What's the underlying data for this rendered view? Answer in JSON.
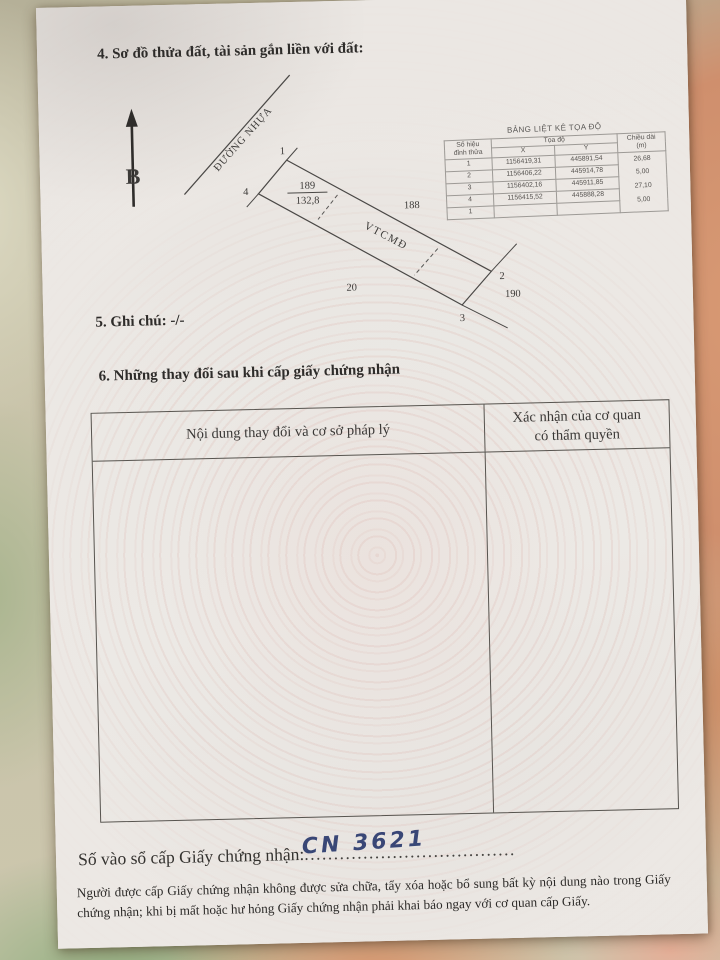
{
  "colors": {
    "ink": "#2e2c2a",
    "handwriting_ink": "#2b3a6e",
    "paper": "#eae6e2"
  },
  "document": {
    "section4_title": "4. Sơ đồ thửa đất, tài sản gắn liền với đất:",
    "section5_text": "5. Ghi chú: -/-",
    "section6_title": "6. Những thay đổi sau khi cấp giấy chứng nhận",
    "registry": {
      "label": "Số vào sổ cấp Giấy chứng nhận:",
      "dots": "....................................",
      "number": "CN 3621"
    },
    "footer_note": "Người được cấp Giấy chứng nhận không được sửa chữa, tẩy xóa hoặc bổ sung bất kỳ nội dung nào trong Giấy chứng nhận; khi bị mất hoặc hư hỏng Giấy chứng nhận phải khai báo ngay với cơ quan cấp Giấy."
  },
  "diagram": {
    "north_label": "B",
    "road_label": "ĐƯỜNG NHỰA",
    "parcel_number": "189",
    "parcel_area": "132,8",
    "zone_label": "VTCMĐ",
    "adjacent_parcel_top": "188",
    "adjacent_parcel_right": "190",
    "adjacent_parcel_bottom": "20",
    "vertex_1": "1",
    "vertex_2": "2",
    "vertex_3": "3",
    "vertex_4": "4"
  },
  "coord_table": {
    "title": "BẢNG LIỆT KÊ TỌA ĐỘ",
    "col_vertex_l1": "Số hiệu",
    "col_vertex_l2": "đỉnh thửa",
    "col_coord": "Tọa độ",
    "col_x": "X",
    "col_y": "Y",
    "col_len_l1": "Chiều dài",
    "col_len_l2": "(m)",
    "rows": [
      {
        "id": "1",
        "x": "1156419,31",
        "y": "445891,54"
      },
      {
        "id": "2",
        "x": "1156406,22",
        "y": "445914,78"
      },
      {
        "id": "3",
        "x": "1156402,16",
        "y": "445911,85"
      },
      {
        "id": "4",
        "x": "1156415,52",
        "y": "445888,28"
      },
      {
        "id": "1",
        "x": "",
        "y": ""
      }
    ],
    "lengths": [
      "26,68",
      "5,00",
      "27,10",
      "5,00"
    ]
  },
  "changes_table": {
    "col1": "Nội dung thay đổi và cơ sở pháp lý",
    "col2_l1": "Xác nhận của cơ quan",
    "col2_l2": "có thẩm quyền"
  }
}
